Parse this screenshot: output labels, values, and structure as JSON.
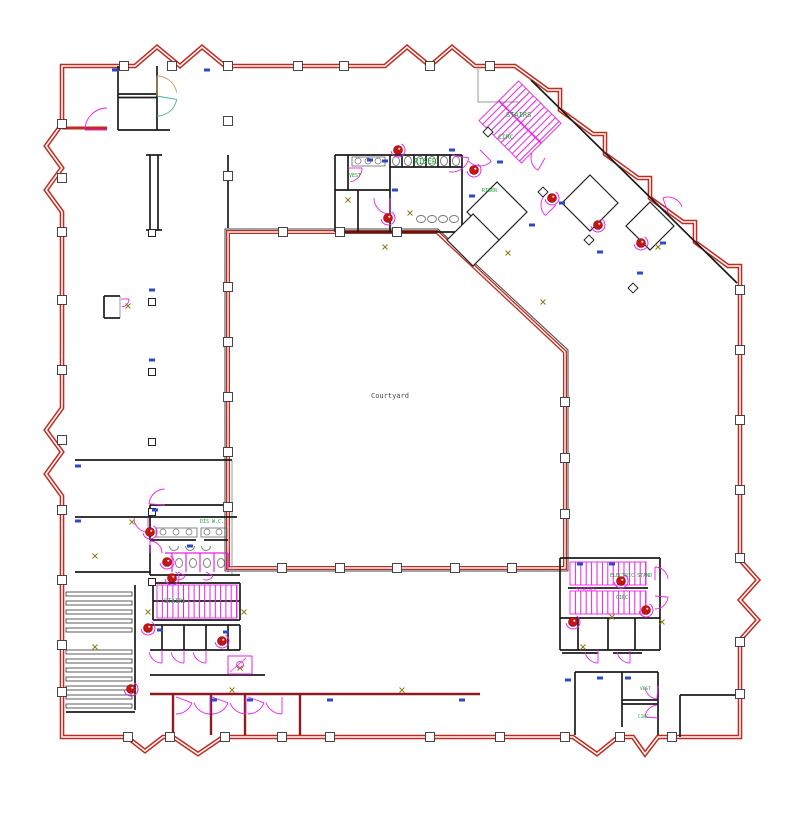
{
  "title": "Ground floor plan - CAD drawing",
  "colors": {
    "wall_red": "#c3291d",
    "wall_maroon": "#8e1b20",
    "wall_black": "#1b1b1b",
    "door_magenta": "#e822e8",
    "label_green": "#17a12e",
    "mark_blue": "#2c49c8",
    "mark_olive": "#8a7a10",
    "fire_red": "#c81414",
    "gray": "#999999",
    "courtyard_text": "#4a4a4a",
    "door_tan": "#c89a5a",
    "door_teal": "#3fae9e"
  },
  "labels": [
    {
      "text": "Courtyard",
      "x": 371,
      "y": 398,
      "size": 7,
      "color": "courtyard_text"
    },
    {
      "text": "RISER",
      "x": 414,
      "y": 164,
      "size": 7.5,
      "color": "label_green"
    },
    {
      "text": "VEST",
      "x": 349,
      "y": 177,
      "size": 5,
      "color": "label_green"
    },
    {
      "text": "STAIRS",
      "x": 506,
      "y": 117,
      "size": 7,
      "color": "label_green"
    },
    {
      "text": "CIRC",
      "x": 498,
      "y": 139,
      "size": 6.5,
      "color": "label_green"
    },
    {
      "text": "RISER",
      "x": 482,
      "y": 192,
      "size": 5,
      "color": "label_green"
    },
    {
      "text": "DIS W.C.",
      "x": 200,
      "y": 523,
      "size": 5,
      "color": "label_green"
    },
    {
      "text": "STAIRS",
      "x": 164,
      "y": 603,
      "size": 6,
      "color": "label_green"
    },
    {
      "text": "STAIRS",
      "x": 576,
      "y": 591,
      "size": 5.5,
      "color": "door_magenta"
    },
    {
      "text": "ELECTRIC STAND",
      "x": 610,
      "y": 577,
      "size": 5,
      "color": "label_green"
    },
    {
      "text": "CIRC",
      "x": 616,
      "y": 599,
      "size": 5,
      "color": "label_green"
    },
    {
      "text": "VEST",
      "x": 640,
      "y": 690,
      "size": 4.5,
      "color": "label_green"
    },
    {
      "text": "CIRC",
      "x": 638,
      "y": 718,
      "size": 4.5,
      "color": "label_green"
    }
  ],
  "drawing": {
    "outer_wall_path": "M 62 66 L 135 66 L 157 47 L 180 66 L 202 47 L 225 66 L 385 66 L 407 47 L 430 66 L 452 47 L 475 66 L 515 66 L 548 90 L 560 90 L 560 110 L 593 134 L 605 134 L 605 154 L 638 178 L 650 178 L 650 198 L 683 222 L 695 222 L 695 242 L 728 266 L 740 266 L 740 560 L 758 580 L 740 600 L 758 620 L 740 640 L 740 737 L 658 737 L 645 754 L 633 737 L 618 737 L 597 754 L 573 737 L 223 737 L 198 754 L 173 737 L 163 737 L 145 751 L 127 737 L 62 737 L 62 496 L 46 474 L 62 452 L 46 430 L 62 408 L 62 212 L 46 190 L 62 168 L 46 146 L 62 124 Z",
    "courtyard_poly": "228,232 437,232 565,352 565,568 228,568",
    "courtyard_outline": "225,229 438,229 568,350 568,571 225,571",
    "red_segs": [
      [
        62,
        128,
        107,
        128
      ]
    ],
    "maroon_segs": [
      [
        150,
        694,
        480,
        694
      ],
      [
        173,
        694,
        173,
        735
      ],
      [
        211,
        694,
        211,
        735
      ],
      [
        245,
        694,
        245,
        735
      ],
      [
        300,
        694,
        300,
        735
      ]
    ],
    "black_segs": [
      [
        118,
        66,
        118,
        130
      ],
      [
        157,
        66,
        157,
        130
      ],
      [
        118,
        94,
        157,
        94
      ],
      [
        118,
        97.5,
        157,
        97.5
      ],
      [
        118,
        130,
        170,
        130
      ],
      [
        150,
        155,
        150,
        230
      ],
      [
        158,
        155,
        158,
        230
      ],
      [
        146,
        155,
        162,
        155
      ],
      [
        146,
        230,
        162,
        230
      ],
      [
        228,
        155,
        228,
        228
      ],
      [
        335,
        155,
        462,
        155
      ],
      [
        335,
        155,
        335,
        232
      ],
      [
        335,
        232,
        462,
        232
      ],
      [
        462,
        155,
        462,
        232
      ],
      [
        390,
        155,
        390,
        232
      ],
      [
        348,
        155,
        348,
        190
      ],
      [
        335,
        190,
        390,
        190
      ],
      [
        358,
        190,
        358,
        232
      ],
      [
        390,
        167,
        462,
        167
      ],
      [
        402,
        155,
        402,
        167
      ],
      [
        414,
        155,
        414,
        167
      ],
      [
        426,
        155,
        426,
        167
      ],
      [
        438,
        155,
        438,
        167
      ],
      [
        450,
        155,
        450,
        167
      ],
      [
        75,
        460,
        232,
        460
      ],
      [
        75,
        517,
        237,
        517
      ],
      [
        75,
        572,
        150,
        572
      ],
      [
        104,
        296,
        104,
        318
      ],
      [
        104,
        296,
        120,
        296
      ],
      [
        104,
        318,
        120,
        318
      ],
      [
        150,
        505,
        228,
        505
      ],
      [
        150,
        505,
        150,
        540
      ],
      [
        150,
        540,
        196,
        540
      ],
      [
        204,
        540,
        228,
        540
      ],
      [
        150,
        545,
        150,
        575
      ],
      [
        150,
        575,
        240,
        575
      ],
      [
        153,
        583,
        240,
        583
      ],
      [
        153,
        583,
        153,
        620
      ],
      [
        240,
        583,
        240,
        620
      ],
      [
        153,
        620,
        240,
        620
      ],
      [
        153,
        601,
        240,
        601
      ],
      [
        150,
        625,
        240,
        625
      ],
      [
        162,
        625,
        162,
        650
      ],
      [
        184,
        625,
        184,
        650
      ],
      [
        206,
        625,
        206,
        650
      ],
      [
        228,
        625,
        228,
        650
      ],
      [
        240,
        625,
        240,
        650
      ],
      [
        150,
        650,
        240,
        650
      ],
      [
        150,
        675,
        265,
        675
      ],
      [
        135,
        585,
        135,
        710
      ],
      [
        66,
        712,
        135,
        712
      ],
      [
        531,
        80,
        737,
        283
      ],
      [
        560,
        558,
        660,
        558
      ],
      [
        560,
        558,
        560,
        618
      ],
      [
        660,
        558,
        660,
        618
      ],
      [
        560,
        618,
        660,
        618
      ],
      [
        568,
        588,
        648,
        588
      ],
      [
        560,
        618,
        560,
        650
      ],
      [
        660,
        618,
        660,
        650
      ],
      [
        578,
        618,
        578,
        650
      ],
      [
        608,
        618,
        608,
        650
      ],
      [
        635,
        618,
        635,
        650
      ],
      [
        560,
        650,
        660,
        650
      ],
      [
        562,
        653,
        598,
        653
      ],
      [
        613,
        653,
        642,
        653
      ],
      [
        575,
        672,
        575,
        735
      ],
      [
        575,
        672,
        658,
        672
      ],
      [
        622,
        672,
        622,
        727
      ],
      [
        622,
        700,
        658,
        700
      ],
      [
        622,
        704,
        658,
        704
      ],
      [
        658,
        672,
        658,
        735
      ],
      [
        680,
        695,
        680,
        737
      ],
      [
        680,
        695,
        740,
        695
      ]
    ],
    "gray_segs": [
      [
        232,
        460,
        232,
        575
      ],
      [
        120,
        296,
        120,
        318
      ],
      [
        478,
        66,
        478,
        102
      ],
      [
        478,
        102,
        520,
        102
      ]
    ],
    "magenta_segs": [
      [
        165,
        553,
        228,
        553
      ],
      [
        172,
        553,
        172,
        572
      ],
      [
        186,
        553,
        186,
        572
      ],
      [
        200,
        553,
        200,
        572
      ],
      [
        214,
        553,
        214,
        572
      ],
      [
        228,
        553,
        228,
        572
      ]
    ],
    "diamond_rooms": [
      "497,182 527,212 497,242 467,212",
      "473,214 499,240 473,266 447,240",
      "590,175 618,203 590,231 562,203",
      "650,202 674,226 650,250 626,226"
    ],
    "stairs": [
      {
        "x": 490,
        "y": 94,
        "w": 60,
        "h": 56,
        "step": 5.2,
        "rot": 45,
        "cx": 520,
        "cy": 122,
        "rail": true
      },
      {
        "x": 157,
        "y": 585,
        "w": 80,
        "h": 33,
        "step": 5.3,
        "rot": 0,
        "rail": false
      },
      {
        "x": 570,
        "y": 562,
        "w": 76,
        "h": 23,
        "step": 5.4,
        "rot": 0,
        "rail": false
      },
      {
        "x": 570,
        "y": 591,
        "w": 76,
        "h": 23,
        "step": 5.4,
        "rot": 0,
        "rail": false
      }
    ],
    "door_arcs": [
      [
        107,
        130,
        22,
        180,
        270
      ],
      [
        157,
        96,
        20,
        270,
        350,
        "door_tan"
      ],
      [
        157,
        96,
        20,
        10,
        90,
        "door_teal"
      ],
      [
        390,
        198,
        16,
        90,
        180
      ],
      [
        348,
        168,
        14,
        0,
        80
      ],
      [
        452,
        155,
        17,
        10,
        100
      ],
      [
        480,
        150,
        16,
        45,
        135
      ],
      [
        556,
        205,
        15,
        135,
        225
      ],
      [
        668,
        212,
        15,
        250,
        340
      ],
      [
        148,
        518,
        14,
        90,
        180
      ],
      [
        150,
        553,
        12,
        270,
        360
      ],
      [
        178,
        572,
        8,
        30,
        110
      ],
      [
        206,
        572,
        8,
        30,
        110
      ],
      [
        162,
        650,
        13,
        90,
        170
      ],
      [
        184,
        650,
        13,
        90,
        170
      ],
      [
        206,
        650,
        13,
        90,
        170
      ],
      [
        165,
        505,
        16,
        184,
        268
      ],
      [
        176,
        697,
        17,
        20,
        90
      ],
      [
        210,
        697,
        17,
        90,
        160
      ],
      [
        212,
        697,
        17,
        20,
        90
      ],
      [
        246,
        697,
        17,
        90,
        160
      ],
      [
        248,
        697,
        17,
        20,
        90
      ],
      [
        282,
        697,
        17,
        90,
        160
      ],
      [
        655,
        580,
        13,
        270,
        355
      ],
      [
        655,
        596,
        13,
        5,
        90
      ],
      [
        598,
        650,
        13,
        90,
        170
      ],
      [
        630,
        650,
        13,
        90,
        170
      ],
      [
        658,
        686,
        13,
        95,
        175
      ],
      [
        658,
        718,
        13,
        185,
        265
      ],
      [
        121,
        299,
        8,
        0,
        85
      ],
      [
        545,
        158,
        14,
        120,
        200
      ]
    ],
    "fire_reels": [
      [
        398,
        150
      ],
      [
        474,
        170
      ],
      [
        388,
        218
      ],
      [
        552,
        198
      ],
      [
        598,
        225
      ],
      [
        641,
        243
      ],
      [
        150,
        532
      ],
      [
        167,
        562
      ],
      [
        172,
        578
      ],
      [
        148,
        628
      ],
      [
        222,
        641
      ],
      [
        131,
        689
      ],
      [
        621,
        581
      ],
      [
        646,
        610
      ],
      [
        573,
        622
      ]
    ],
    "wall_columns": {
      "left": {
        "x": 62,
        "ys": [
          124,
          178,
          232,
          300,
          370,
          440,
          510,
          580,
          645,
          692
        ]
      },
      "top": {
        "y": 66,
        "xs": [
          124,
          172,
          228,
          298,
          344,
          430,
          490
        ]
      },
      "bottom": {
        "y": 737,
        "xs": [
          128,
          170,
          225,
          282,
          330,
          430,
          500,
          565,
          620,
          672
        ]
      },
      "right": {
        "x": 740,
        "ys": [
          290,
          350,
          420,
          490,
          558,
          642,
          694
        ]
      },
      "cy_left": {
        "x": 228,
        "ys": [
          121,
          176,
          287,
          342,
          397,
          452,
          507
        ]
      },
      "cy_bot": {
        "y": 568,
        "xs": [
          282,
          340,
          397,
          455,
          512
        ]
      },
      "cy_top": {
        "y": 232,
        "xs": [
          283,
          340,
          397
        ]
      },
      "cy_right": {
        "x": 565,
        "ys": [
          402,
          458,
          514
        ]
      }
    },
    "grid_squares": [
      [
        152,
        233
      ],
      [
        152,
        302
      ],
      [
        152,
        372
      ],
      [
        152,
        442
      ],
      [
        152,
        512
      ],
      [
        152,
        582
      ]
    ],
    "diamond_columns": [
      [
        543,
        192
      ],
      [
        589,
        240
      ],
      [
        633,
        288
      ],
      [
        488,
        132
      ]
    ],
    "blue_ticks": [
      [
        115,
        70
      ],
      [
        207,
        70
      ],
      [
        385,
        161
      ],
      [
        395,
        190
      ],
      [
        452,
        150
      ],
      [
        472,
        196
      ],
      [
        500,
        162
      ],
      [
        532,
        225
      ],
      [
        562,
        203
      ],
      [
        600,
        252
      ],
      [
        640,
        273
      ],
      [
        663,
        243
      ],
      [
        78,
        466
      ],
      [
        78,
        521
      ],
      [
        155,
        510
      ],
      [
        190,
        546
      ],
      [
        160,
        630
      ],
      [
        226,
        632
      ],
      [
        580,
        564
      ],
      [
        612,
        564
      ],
      [
        568,
        680
      ],
      [
        600,
        678
      ],
      [
        628,
        678
      ],
      [
        214,
        700
      ],
      [
        250,
        700
      ],
      [
        330,
        700
      ],
      [
        462,
        700
      ],
      [
        152,
        290
      ],
      [
        152,
        360
      ],
      [
        370,
        160
      ]
    ],
    "olive_marks": [
      [
        128,
        306
      ],
      [
        348,
        200
      ],
      [
        410,
        213
      ],
      [
        385,
        247
      ],
      [
        508,
        253
      ],
      [
        543,
        302
      ],
      [
        658,
        247
      ],
      [
        95,
        556
      ],
      [
        132,
        522
      ],
      [
        148,
        612
      ],
      [
        244,
        612
      ],
      [
        95,
        647
      ],
      [
        402,
        690
      ],
      [
        232,
        690
      ],
      [
        612,
        617
      ],
      [
        662,
        622
      ],
      [
        240,
        668
      ],
      [
        583,
        647
      ]
    ],
    "shelves": {
      "x": 66,
      "w": 66,
      "h": 4,
      "rows": [
        592,
        601,
        610,
        619,
        628,
        650,
        659,
        668,
        677,
        686,
        695,
        704
      ]
    },
    "toilets": [
      [
        396,
        161
      ],
      [
        408,
        161
      ],
      [
        420,
        161
      ],
      [
        432,
        161
      ],
      [
        444,
        161
      ],
      [
        456,
        161
      ],
      [
        179,
        563
      ],
      [
        193,
        563
      ],
      [
        207,
        563
      ],
      [
        221,
        563
      ]
    ],
    "sinks": [
      [
        421,
        219
      ],
      [
        432,
        219
      ],
      [
        443,
        219
      ],
      [
        454,
        219
      ]
    ],
    "counters": [
      [
        352,
        157,
        33,
        9
      ],
      [
        156,
        528,
        41,
        9
      ],
      [
        201,
        528,
        26,
        9
      ]
    ],
    "counter_circles": [
      [
        358,
        161
      ],
      [
        368,
        161
      ],
      [
        378,
        161
      ],
      [
        163,
        532
      ],
      [
        176,
        532
      ],
      [
        189,
        532
      ],
      [
        207,
        532
      ],
      [
        219,
        532
      ]
    ],
    "urinals": [
      [
        174,
        546
      ],
      [
        190,
        546
      ],
      [
        206,
        546
      ]
    ],
    "pantry": {
      "x": 228,
      "y": 656,
      "w": 24,
      "h": 18,
      "cx": 240,
      "cy": 665,
      "r": 3.5
    }
  }
}
